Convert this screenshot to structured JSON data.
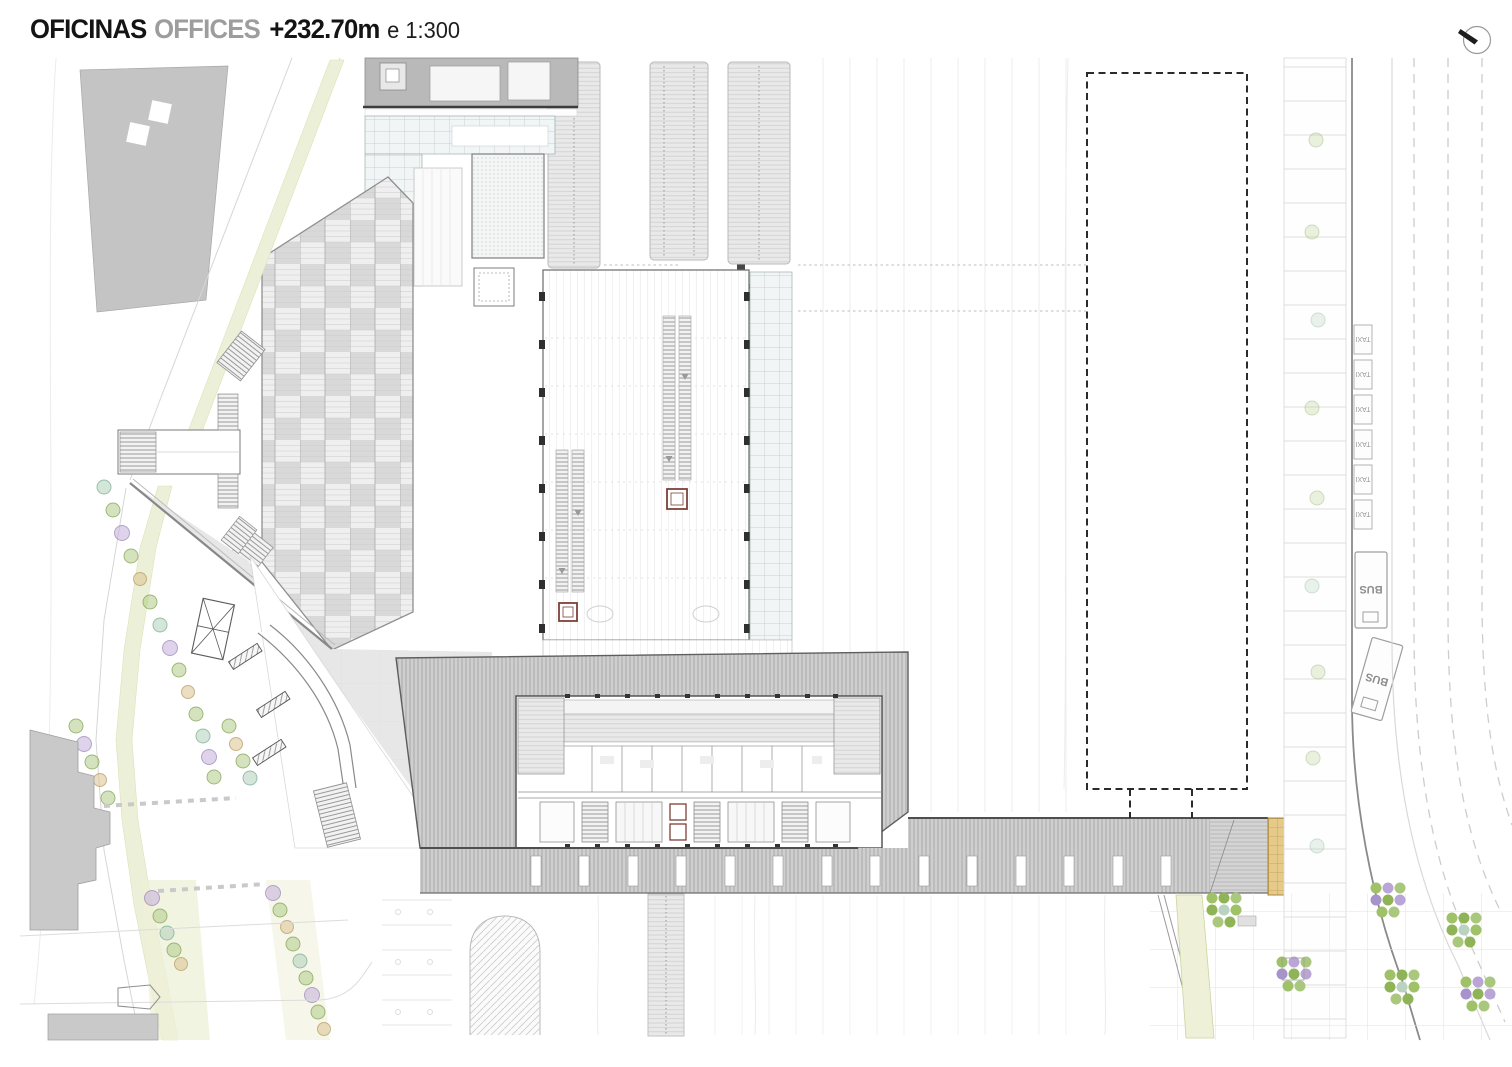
{
  "header": {
    "title_primary": "OFICINAS",
    "title_secondary": "OFFICES",
    "elevation": "+232.70m",
    "scale_note": "e 1:300"
  },
  "labels": {
    "taxi": "TAXI",
    "bus": "BUS"
  },
  "icons": {
    "north": "north-arrow"
  },
  "colors": {
    "ink": "#2f2f2f",
    "title_gray": "#9d9d9d",
    "building_gray": "#c4c4c4",
    "roof_gray": "#cdcdcd",
    "canopy_gray": "#e9e9e9",
    "glass_tint": "#f2f5f5",
    "median_green": "#eef0d8",
    "tree_green": "#a9c87d",
    "tree_purple": "#c2aed8",
    "tree_tan": "#dbc28f",
    "tree_teal": "#a9cbb5",
    "deck_tan": "#e6ca8a"
  }
}
